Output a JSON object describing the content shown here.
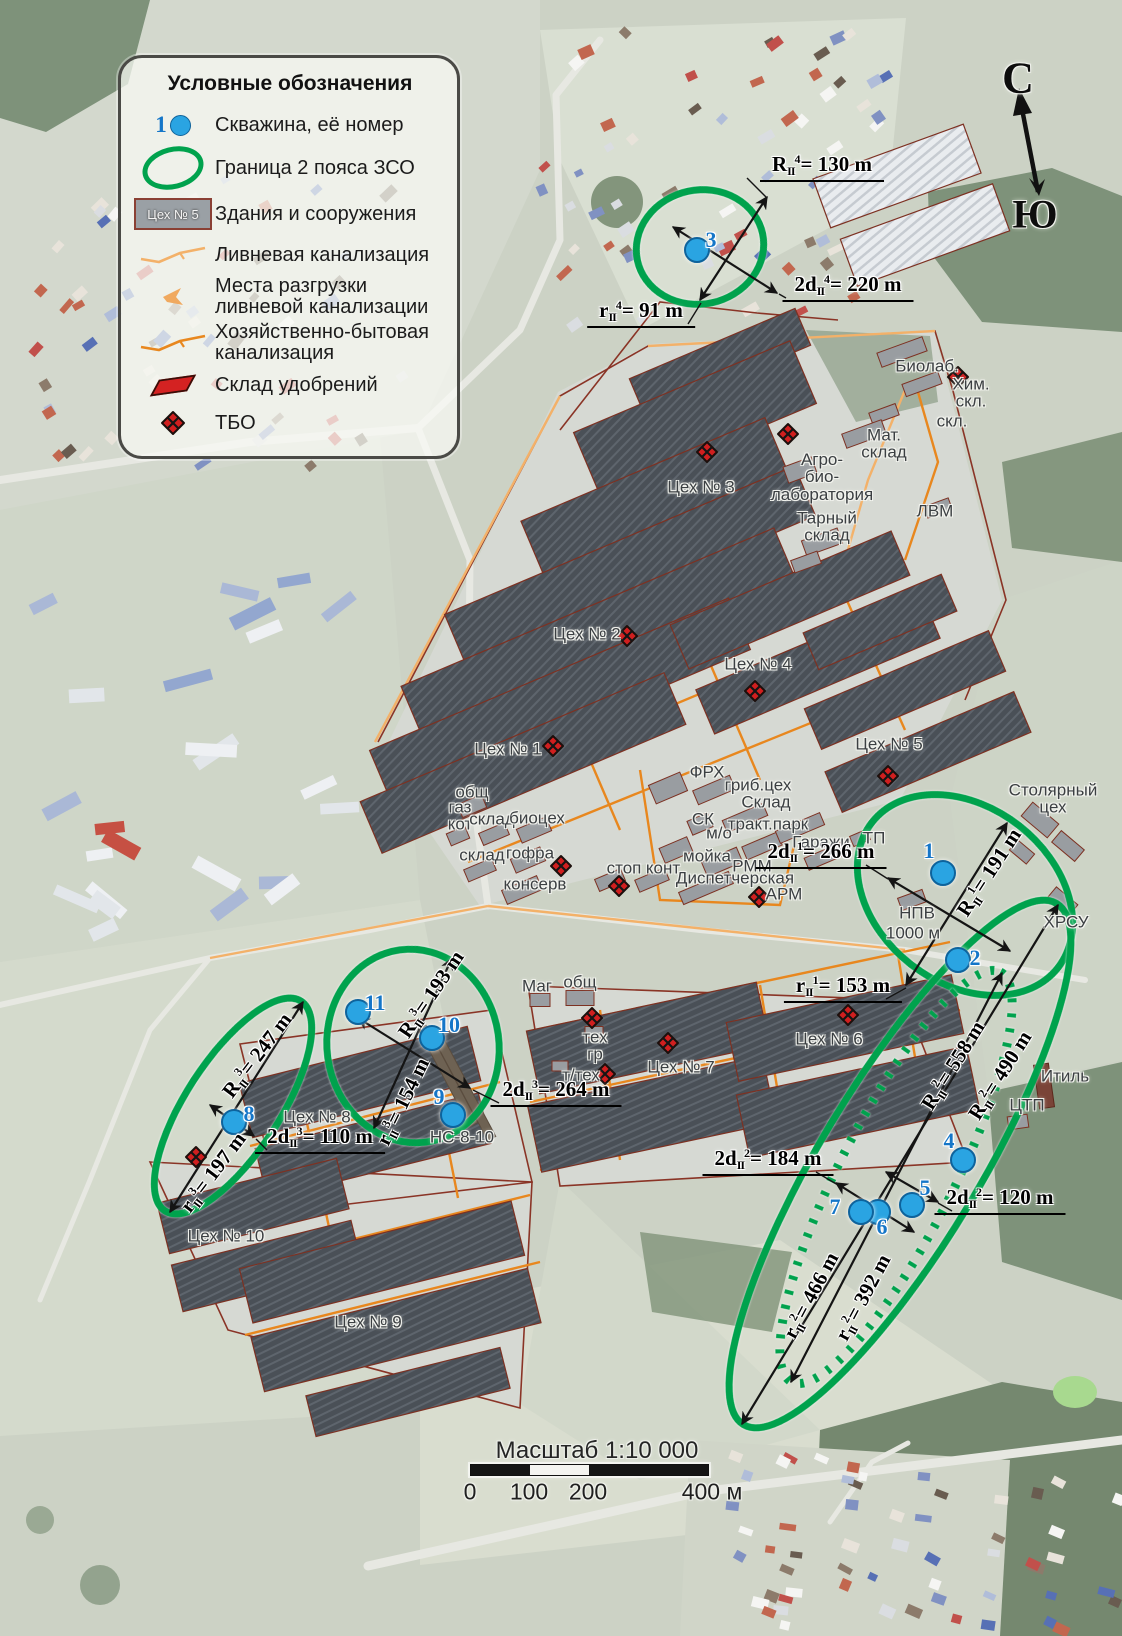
{
  "legend": {
    "title": "Условные обозначения",
    "items": [
      {
        "number": "1",
        "label": "Скважина, её номер"
      },
      {
        "label": "Граница 2 пояса ЗСО"
      },
      {
        "swatch": "Цех № 5",
        "label": "Здания и сооружения"
      },
      {
        "label": "Ливневая канализация"
      },
      {
        "label": "Места разгрузки\nливневой канализации"
      },
      {
        "label": "Хозяйственно-бытовая\nканализация"
      },
      {
        "label": "Склад удобрений"
      },
      {
        "label": "ТБО"
      }
    ]
  },
  "compass": {
    "north": "С",
    "south": "Ю"
  },
  "scale": {
    "title": "Масштаб 1:10 000",
    "ticks": [
      "0",
      "100",
      "200",
      "400 м"
    ]
  },
  "colors": {
    "zone_green": "#00a24d",
    "well_blue": "#2aa4e2",
    "well_number_blue": "#1576c8",
    "domestic_sewer_orange": "#e8871e",
    "storm_sewer_orange": "#f3b169",
    "tbo_red": "#d01f1f",
    "building_outline_red": "#8a3426"
  },
  "wells": [
    {
      "n": "1",
      "x": 943,
      "y": 873,
      "lx": -14,
      "ly": -22
    },
    {
      "n": "2",
      "x": 958,
      "y": 960,
      "lx": 17,
      "ly": -2
    },
    {
      "n": "3",
      "x": 697,
      "y": 250,
      "lx": 14,
      "ly": -10
    },
    {
      "n": "4",
      "x": 963,
      "y": 1160,
      "lx": -14,
      "ly": -19
    },
    {
      "n": "5",
      "x": 912,
      "y": 1205,
      "lx": 13,
      "ly": -17
    },
    {
      "n": "6",
      "x": 878,
      "y": 1212,
      "lx": 4,
      "ly": 15
    },
    {
      "n": "7",
      "x": 861,
      "y": 1212,
      "lx": -26,
      "ly": -5
    },
    {
      "n": "8",
      "x": 234,
      "y": 1122,
      "lx": 15,
      "ly": -8
    },
    {
      "n": "9",
      "x": 453,
      "y": 1115,
      "lx": -14,
      "ly": -18
    },
    {
      "n": "10",
      "x": 432,
      "y": 1038,
      "lx": 17,
      "ly": -13
    },
    {
      "n": "11",
      "x": 358,
      "y": 1012,
      "lx": 17,
      "ly": -9
    }
  ],
  "zones": [
    {
      "name": "zone-well-3",
      "cx": 700,
      "cy": 247,
      "rx": 64,
      "ry": 57,
      "rot": -12,
      "style": "solid"
    },
    {
      "name": "zone-wells-1-2",
      "cx": 965,
      "cy": 895,
      "rx": 118,
      "ry": 88,
      "rot": 38,
      "style": "solid"
    },
    {
      "name": "zone-wells-4-7",
      "cx": 900,
      "cy": 1164,
      "rx": 304,
      "ry": 80,
      "rot": -59,
      "style": "solid"
    },
    {
      "name": "zone-wells-4-7-est",
      "cx": 896,
      "cy": 1177,
      "rx": 230,
      "ry": 57,
      "rot": -63,
      "style": "dotted"
    },
    {
      "name": "zone-well-8",
      "cx": 233,
      "cy": 1106,
      "rx": 125,
      "ry": 47,
      "rot": -57,
      "style": "solid"
    },
    {
      "name": "zone-wells-9-11",
      "cx": 413,
      "cy": 1046,
      "rx": 86,
      "ry": 97,
      "rot": -8,
      "style": "solid"
    }
  ],
  "arrows": [
    {
      "x1": 673,
      "y1": 227,
      "x2": 777,
      "y2": 293
    },
    {
      "x1": 700,
      "y1": 300,
      "x2": 767,
      "y2": 197
    },
    {
      "x1": 888,
      "y1": 878,
      "x2": 1010,
      "y2": 951
    },
    {
      "x1": 906,
      "y1": 985,
      "x2": 1007,
      "y2": 823
    },
    {
      "x1": 1058,
      "y1": 905,
      "x2": 742,
      "y2": 1424
    },
    {
      "x1": 1002,
      "y1": 973,
      "x2": 791,
      "y2": 1382
    },
    {
      "x1": 836,
      "y1": 1183,
      "x2": 914,
      "y2": 1232
    },
    {
      "x1": 886,
      "y1": 1172,
      "x2": 938,
      "y2": 1202
    },
    {
      "x1": 303,
      "y1": 1002,
      "x2": 170,
      "y2": 1212
    },
    {
      "x1": 210,
      "y1": 1105,
      "x2": 254,
      "y2": 1136
    },
    {
      "x1": 358,
      "y1": 1018,
      "x2": 470,
      "y2": 1088
    },
    {
      "x1": 374,
      "y1": 1128,
      "x2": 452,
      "y2": 958
    }
  ],
  "leaders": [
    [
      747,
      178,
      766,
      197
    ],
    [
      786,
      298,
      779,
      294
    ],
    [
      688,
      324,
      701,
      303
    ],
    [
      866,
      865,
      888,
      879
    ],
    [
      886,
      999,
      906,
      988
    ],
    [
      816,
      1172,
      838,
      1185
    ],
    [
      952,
      1211,
      938,
      1203
    ],
    [
      267,
      1150,
      256,
      1139
    ],
    [
      499,
      1103,
      473,
      1090
    ]
  ],
  "measurements": [
    {
      "base": "R",
      "sub": "II",
      "sup": "4",
      "value": "= 130 m",
      "x": 822,
      "y": 167,
      "rot": 0,
      "ul": true
    },
    {
      "base": "2d",
      "sub": "II",
      "sup": "4",
      "value": "= 220 m",
      "x": 848,
      "y": 287,
      "rot": 0,
      "ul": true
    },
    {
      "base": "r",
      "sub": "II",
      "sup": "4",
      "value": "= 91 m",
      "x": 641,
      "y": 313,
      "rot": 0,
      "ul": true
    },
    {
      "base": "2d",
      "sub": "II",
      "sup": "1",
      "value": "= 266 m",
      "x": 821,
      "y": 854,
      "rot": 0,
      "ul": true
    },
    {
      "base": "R",
      "sub": "II",
      "sup": "1",
      "value": "= 191 m",
      "x": 990,
      "y": 873,
      "rot": -57,
      "ul": false
    },
    {
      "base": "r",
      "sub": "II",
      "sup": "1",
      "value": "= 153 m",
      "x": 843,
      "y": 988,
      "rot": 0,
      "ul": true
    },
    {
      "base": "2d",
      "sub": "II",
      "sup": "2",
      "value": "= 184 m",
      "x": 768,
      "y": 1161,
      "rot": 0,
      "ul": true
    },
    {
      "base": "2d",
      "sub": "II",
      "sup": "2",
      "value": "= 120 m",
      "x": 1000,
      "y": 1200,
      "rot": 0,
      "ul": true
    },
    {
      "base": "R",
      "sub": "II",
      "sup": "2",
      "value": "= 558 m",
      "x": 954,
      "y": 1066,
      "rot": -58,
      "ul": false
    },
    {
      "base": "R",
      "sub": "II",
      "sup": "2",
      "value": "= 490 m",
      "x": 1001,
      "y": 1076,
      "rot": -58,
      "ul": false
    },
    {
      "base": "r",
      "sub": "II",
      "sup": "2",
      "value": "= 466 m",
      "x": 812,
      "y": 1296,
      "rot": -62,
      "ul": false
    },
    {
      "base": "r",
      "sub": "II",
      "sup": "2",
      "value": "= 392 m",
      "x": 864,
      "y": 1298,
      "rot": -62,
      "ul": false
    },
    {
      "base": "R",
      "sub": "II",
      "sup": "3",
      "value": "= 247 m",
      "x": 258,
      "y": 1056,
      "rot": -53,
      "ul": false
    },
    {
      "base": "r",
      "sub": "II",
      "sup": "3",
      "value": "= 197 m",
      "x": 214,
      "y": 1173,
      "rot": -53,
      "ul": false
    },
    {
      "base": "2d",
      "sub": "II",
      "sup": "3",
      "value": "= 110 m",
      "x": 320,
      "y": 1139,
      "rot": 0,
      "ul": true
    },
    {
      "base": "R",
      "sub": "II",
      "sup": "3",
      "value": "= 193 m",
      "x": 432,
      "y": 995,
      "rot": -56,
      "ul": false
    },
    {
      "base": "r",
      "sub": "II",
      "sup": "3",
      "value": "= 154 m",
      "x": 404,
      "y": 1102,
      "rot": -64,
      "ul": false
    },
    {
      "base": "2d",
      "sub": "II",
      "sup": "3",
      "value": "= 264 m",
      "x": 556,
      "y": 1092,
      "rot": 0,
      "ul": true
    }
  ],
  "map_labels": [
    {
      "t": "Биолаб.",
      "x": 927,
      "y": 366
    },
    {
      "t": "Хим.\nскл.",
      "x": 971,
      "y": 393
    },
    {
      "t": "скл.",
      "x": 952,
      "y": 421
    },
    {
      "t": "Мат.\nсклад",
      "x": 884,
      "y": 444
    },
    {
      "t": "Агро-\nбио-\nлаборатория",
      "x": 822,
      "y": 477
    },
    {
      "t": "Цех № 3",
      "x": 701,
      "y": 487
    },
    {
      "t": "Тарный\nсклад",
      "x": 827,
      "y": 527
    },
    {
      "t": "ЛВМ",
      "x": 935,
      "y": 511
    },
    {
      "t": "Цех № 2",
      "x": 587,
      "y": 634
    },
    {
      "t": "Цех № 4",
      "x": 758,
      "y": 664
    },
    {
      "t": "Цех № 1",
      "x": 508,
      "y": 749
    },
    {
      "t": "Цех № 5",
      "x": 889,
      "y": 744
    },
    {
      "t": "ФРХ",
      "x": 707,
      "y": 772
    },
    {
      "t": "гриб.цех",
      "x": 758,
      "y": 785
    },
    {
      "t": "Склад",
      "x": 766,
      "y": 802
    },
    {
      "t": "СК",
      "x": 703,
      "y": 819
    },
    {
      "t": "тракт.парк",
      "x": 768,
      "y": 824
    },
    {
      "t": "м/о",
      "x": 719,
      "y": 833
    },
    {
      "t": "мойка",
      "x": 707,
      "y": 856
    },
    {
      "t": "РММ",
      "x": 752,
      "y": 866
    },
    {
      "t": "Диспетчерская",
      "x": 735,
      "y": 878
    },
    {
      "t": "АРМ",
      "x": 784,
      "y": 894
    },
    {
      "t": "Гаражи",
      "x": 821,
      "y": 842
    },
    {
      "t": "ТП",
      "x": 874,
      "y": 838
    },
    {
      "t": "Столярный\nцех",
      "x": 1053,
      "y": 799
    },
    {
      "t": "ХРСУ",
      "x": 1066,
      "y": 922
    },
    {
      "t": "НПВ",
      "x": 917,
      "y": 913
    },
    {
      "t": "1000 м",
      "x": 913,
      "y": 933
    },
    {
      "t": "общ",
      "x": 472,
      "y": 792
    },
    {
      "t": "газ\nкот",
      "x": 460,
      "y": 816
    },
    {
      "t": "склад",
      "x": 492,
      "y": 819
    },
    {
      "t": "биоцех",
      "x": 537,
      "y": 818
    },
    {
      "t": "склад",
      "x": 482,
      "y": 855
    },
    {
      "t": "гофра",
      "x": 530,
      "y": 853
    },
    {
      "t": "консерв",
      "x": 535,
      "y": 884
    },
    {
      "t": "стоп",
      "x": 624,
      "y": 868
    },
    {
      "t": "конт",
      "x": 663,
      "y": 868
    },
    {
      "t": "Маг",
      "x": 537,
      "y": 986
    },
    {
      "t": "общ",
      "x": 580,
      "y": 982
    },
    {
      "t": "тех\nгр",
      "x": 595,
      "y": 1046
    },
    {
      "t": "т/тех",
      "x": 581,
      "y": 1075
    },
    {
      "t": "Цех № 7",
      "x": 681,
      "y": 1067
    },
    {
      "t": "Цех № 6",
      "x": 829,
      "y": 1039
    },
    {
      "t": "Цех № 8",
      "x": 317,
      "y": 1117
    },
    {
      "t": "НС-8-10",
      "x": 462,
      "y": 1137
    },
    {
      "t": "Цех № 10",
      "x": 226,
      "y": 1236
    },
    {
      "t": "Цех № 9",
      "x": 368,
      "y": 1322
    },
    {
      "t": "Итиль",
      "x": 1065,
      "y": 1076
    },
    {
      "t": "ЦТП",
      "x": 1027,
      "y": 1105
    }
  ],
  "tbo_icons": [
    [
      958,
      377
    ],
    [
      788,
      434
    ],
    [
      707,
      452
    ],
    [
      627,
      636
    ],
    [
      755,
      691
    ],
    [
      553,
      746
    ],
    [
      888,
      776
    ],
    [
      561,
      866
    ],
    [
      619,
      886
    ],
    [
      759,
      897
    ],
    [
      592,
      1018
    ],
    [
      668,
      1043
    ],
    [
      848,
      1015
    ],
    [
      605,
      1074
    ],
    [
      196,
      1157
    ]
  ]
}
